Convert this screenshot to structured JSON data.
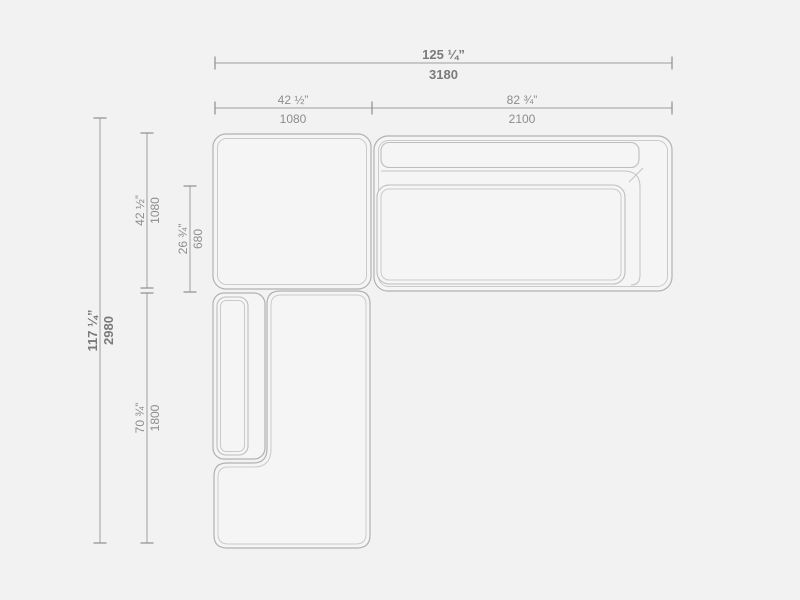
{
  "colors": {
    "background": "#f2f2f2",
    "module_fill": "#f5f5f5",
    "outline_dark": "#b2b2b2",
    "outline_light": "#cacaca",
    "dimension_line": "#9f9f9f",
    "dimension_text": "#8d8d8d",
    "dimension_text_emphasis": "#7a7a7a"
  },
  "dimensions": {
    "overall_width": {
      "inches": "125 ¼”",
      "mm": "3180"
    },
    "corner_module_width": {
      "inches": "42 ½”",
      "mm": "1080"
    },
    "sofa_module_width": {
      "inches": "82 ¾”",
      "mm": "2100"
    },
    "overall_depth": {
      "inches": "117 ¼”",
      "mm": "2980"
    },
    "corner_module_depth": {
      "inches": "42 ½”",
      "mm": "1080"
    },
    "seat_depth": {
      "inches": "26 ¾”",
      "mm": "680"
    },
    "chaise_module_depth": {
      "inches": "70 ¾”",
      "mm": "1800"
    }
  }
}
